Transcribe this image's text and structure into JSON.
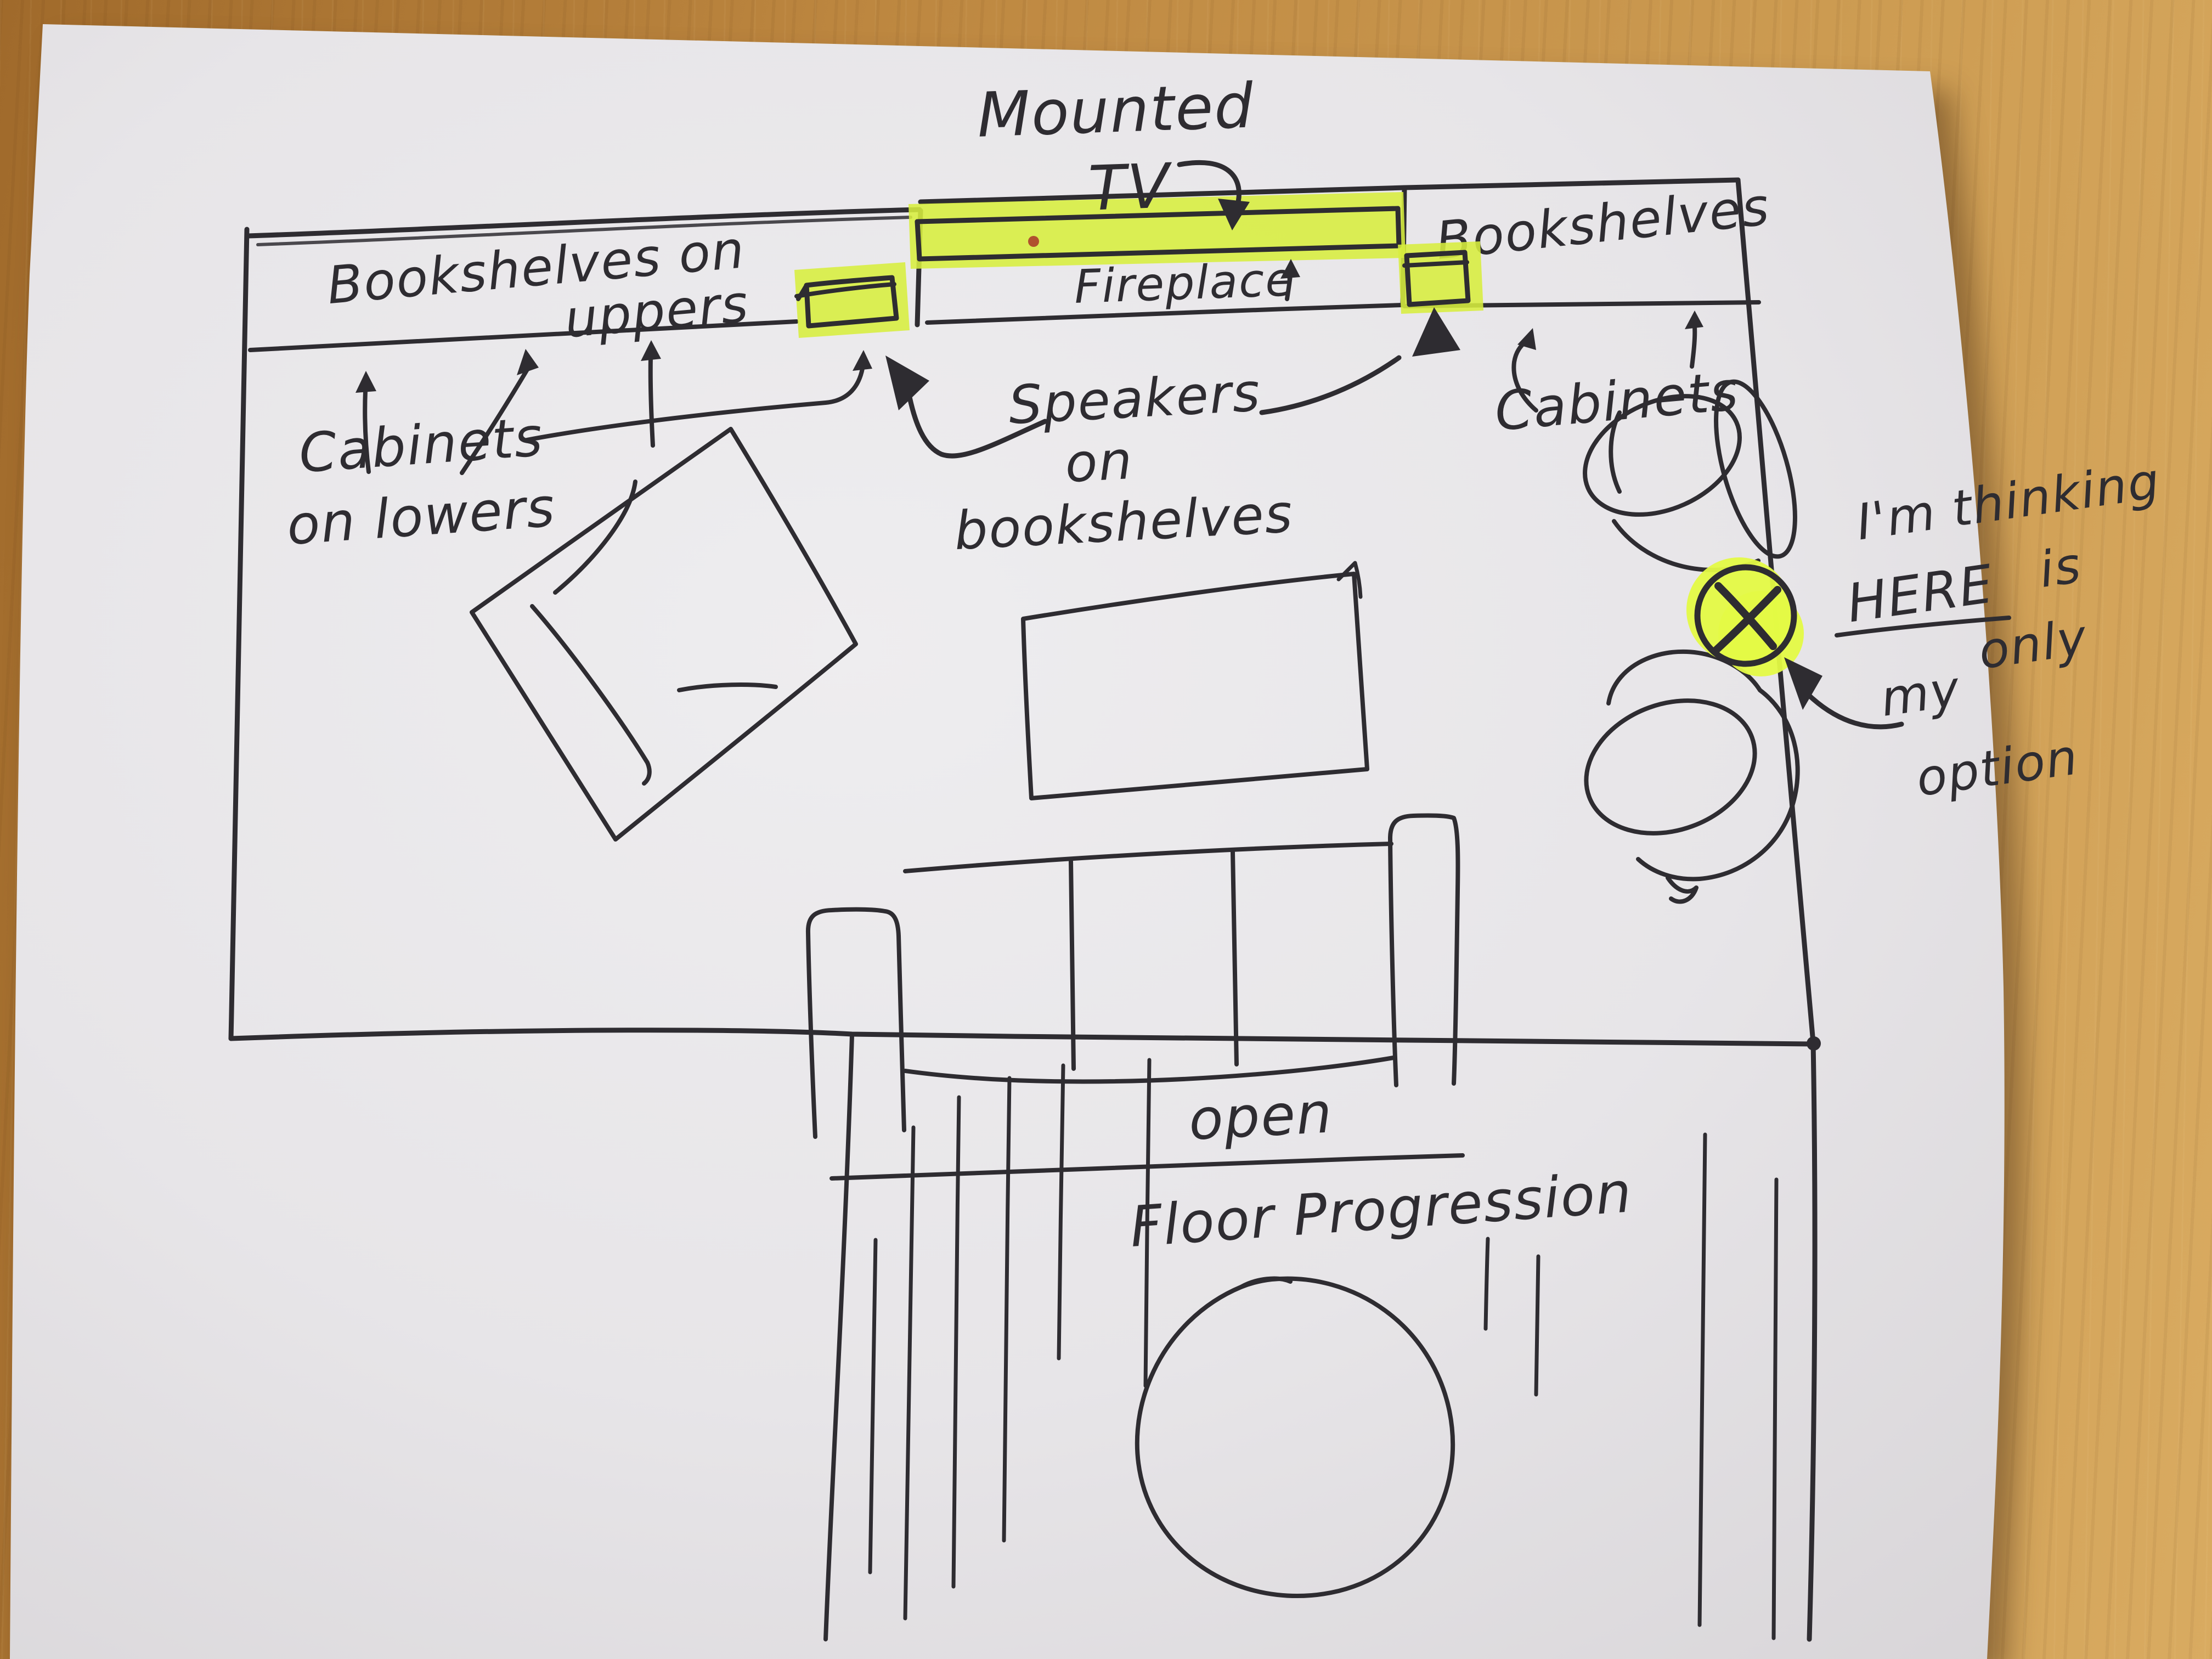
{
  "colors": {
    "wood_dark": "#a06a2b",
    "wood_mid": "#bd8740",
    "wood_light": "#cd9c52",
    "wood_lighter": "#d9ab61",
    "paper_center": "#ecebed",
    "paper_edge": "#d9d6d9",
    "ink": "#2e2c31",
    "highlighter": "#d7ee3e",
    "highlighter_bright": "#e4fa45",
    "accent_dot": "#b0512e"
  },
  "labels": {
    "mounted_tv": {
      "line1": "Mounted",
      "line2": "TV"
    },
    "bookshelves_uppers": {
      "line1": "Bookshelves on",
      "line2": "uppers"
    },
    "fireplace": "Fireplace",
    "bookshelves_right": "Bookshelves",
    "cabinets_lowers": {
      "line1": "Cabinets",
      "line2": "on lowers"
    },
    "speakers": {
      "line1": "Speakers",
      "line2": "on",
      "line3": "bookshelves"
    },
    "cabinets_right": "Cabinets",
    "note": {
      "line1": "I'm thinking",
      "here": "HERE",
      "is": "is",
      "my": "my",
      "only": "only",
      "option": "option"
    },
    "x_marker": "X",
    "open_floor": {
      "line1": "open",
      "line2": "Floor Progression"
    }
  }
}
